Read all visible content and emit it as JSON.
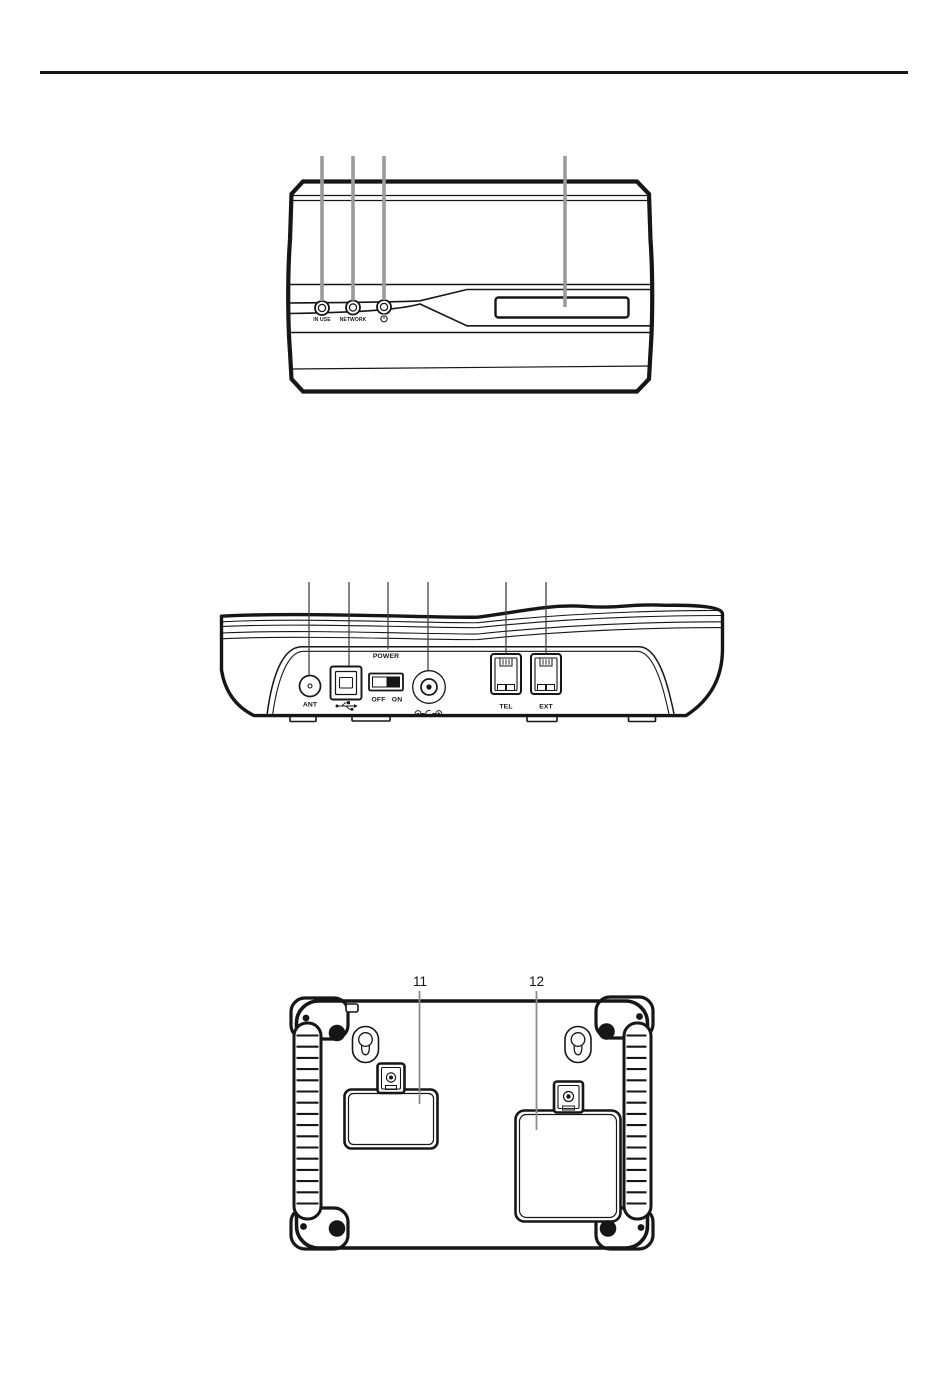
{
  "page": {
    "background_color": "#ffffff",
    "header_rule_color": "#161616"
  },
  "colors": {
    "line_color": "#161616",
    "front_callout_color": "#9b9b9b",
    "rear_callout_color": "#3c3c3c",
    "bottom_leader_color": "#8c8c8c"
  },
  "front_view": {
    "led_in_use_label": "IN USE",
    "led_network_label": "NETWORK",
    "power_led_icon": "power-standby-icon"
  },
  "rear_view": {
    "ant_label": "ANT",
    "usb_icon": "usb-trident-icon",
    "power_label": "POWER",
    "off_label": "OFF",
    "on_label": "ON",
    "dc_polarity_icon": "dc-polarity-icon",
    "tel_label": "TEL",
    "ext_label": "EXT"
  },
  "bottom_view": {
    "callout_11": "11",
    "callout_12": "12"
  }
}
